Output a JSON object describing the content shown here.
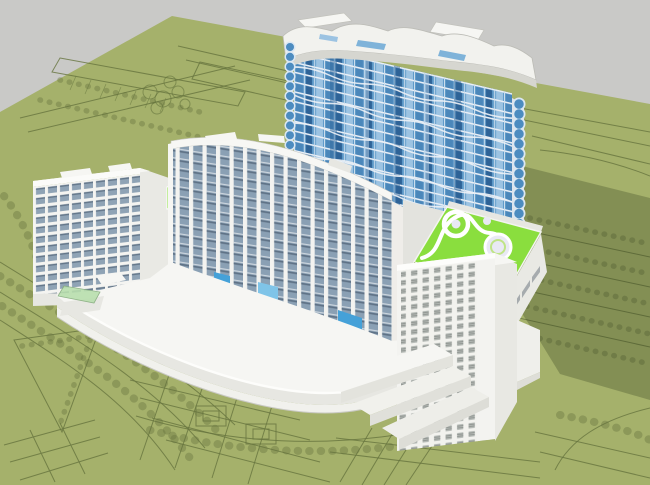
{
  "scene": {
    "kind": "aerial-3d-architectural-massing-render",
    "sky": "plain gray sky",
    "site": "olive-green ground plane with drawn site plan: roads, parking rows, tree circles, plazas and a triangular park",
    "buildings": [
      {
        "id": "wave-tower",
        "label": "high-rise tower with wavy white balcony bands and blue glazing",
        "floors_visible": 14
      },
      {
        "id": "left-slab",
        "label": "mid-rise slab block with white piers and blue-gray strip windows"
      },
      {
        "id": "curved-slab",
        "label": "curved slab block with vertical white mullions over an arcing podium"
      },
      {
        "id": "curved-podium",
        "label": "long curved low white podium wing with stepped ends"
      },
      {
        "id": "terraced-midrise",
        "label": "white mid-rise block with louvered windows and stepped terraces"
      },
      {
        "id": "green-roof-pavilion",
        "label": "low pavilion with lime-green play roof, white circles and S-path"
      },
      {
        "id": "connector-block",
        "label": "small connector with lime roof and dark glazed wall"
      }
    ],
    "lighting": "sun from upper left, long shadow cast to the lower right"
  },
  "colors": {
    "sky": "#c9c9c7",
    "ground": "#a5b16b",
    "ground_line": "#66743e",
    "shadow_tint": "#232d12",
    "white_lit": "#f5f5f2",
    "white_shade": "#e7e7e2",
    "white_dark": "#d6d6d0",
    "slab_window": "#8fa3b5",
    "slab_window_dark": "#5f7286",
    "tower_glass": "#5e9ac9",
    "tower_glass_dark": "#2e6397",
    "tower_glass_light": "#9cc3e2",
    "tower_band": "#e9eff6",
    "balcony_blue": "#4d8cc0",
    "base_blue": "#45a1d8",
    "roof_lime": "#8ade3e",
    "roof_circle": "#e9e9f4",
    "glass_canopy_green": "#b9dfae",
    "connector_glass_dark": "#2f3a42"
  }
}
